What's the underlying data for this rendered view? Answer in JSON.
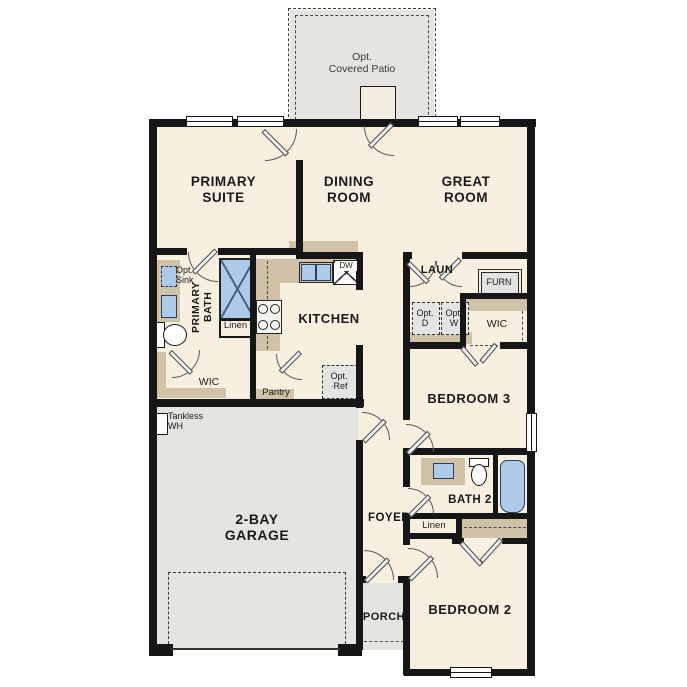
{
  "palette": {
    "floor_cream": "#f7efe0",
    "floor_gray": "#e5e4e1",
    "counter_tan": "#cfc2a6",
    "fixture_blue": "#aecae9",
    "wall_black": "#161616"
  },
  "rooms": {
    "patio": {
      "label": "Opt.\nCovered Patio"
    },
    "primary_suite": {
      "label": "PRIMARY\nSUITE"
    },
    "dining": {
      "label": "DINING\nROOM"
    },
    "great": {
      "label": "GREAT\nROOM"
    },
    "primary_bath": {
      "label": "PRIMARY\nBATH"
    },
    "opt_sink": {
      "label": "Opt.\nSink"
    },
    "linen1": {
      "label": "Linen"
    },
    "wic1": {
      "label": "WIC"
    },
    "kitchen": {
      "label": "KITCHEN"
    },
    "dw": {
      "label": "DW"
    },
    "pantry": {
      "label": "Pantry"
    },
    "opt_ref": {
      "label": "Opt.\n·Ref"
    },
    "laundry": {
      "label": "LAUN"
    },
    "furnace": {
      "label": "FURN"
    },
    "opt_dryer": {
      "label": "Opt.\nD"
    },
    "opt_washer": {
      "label": "Opt.\nW"
    },
    "wic2": {
      "label": "WIC"
    },
    "bedroom3": {
      "label": "BEDROOM 3"
    },
    "bath2": {
      "label": "BATH 2"
    },
    "linen2": {
      "label": "Linen"
    },
    "tankless": {
      "label": "Tankless\nWH"
    },
    "garage": {
      "label": "2-BAY\nGARAGE"
    },
    "foyer": {
      "label": "FOYER"
    },
    "porch": {
      "label": "PORCH"
    },
    "bedroom2": {
      "label": "BEDROOM 2"
    }
  }
}
